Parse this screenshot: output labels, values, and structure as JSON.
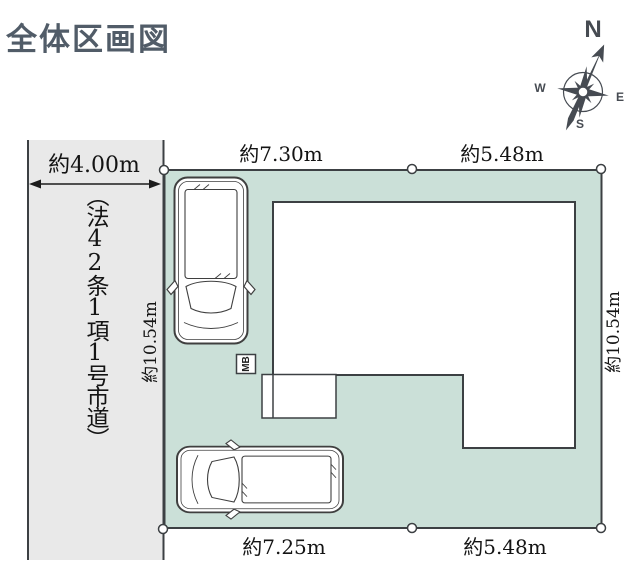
{
  "title": "全体区画図",
  "compass": {
    "north": "N",
    "west": "W",
    "east": "E",
    "south": "S"
  },
  "road": {
    "width_label": "約4.00m",
    "name_vertical": "（法42条1項1号市道）"
  },
  "plot": {
    "top_dimensions": {
      "left": "約7.30m",
      "right": "約5.48m"
    },
    "bottom_dimensions": {
      "left": "約7.25m",
      "right": "約5.48m"
    },
    "side_dimensions": {
      "left": "約10.54m",
      "right": "約10.54m"
    }
  },
  "meter_box_label": "MB",
  "colors": {
    "plot_fill": "#cbe0d8",
    "road_fill": "#e9e9e9",
    "line": "#3c4043",
    "title_text": "#515c68"
  }
}
